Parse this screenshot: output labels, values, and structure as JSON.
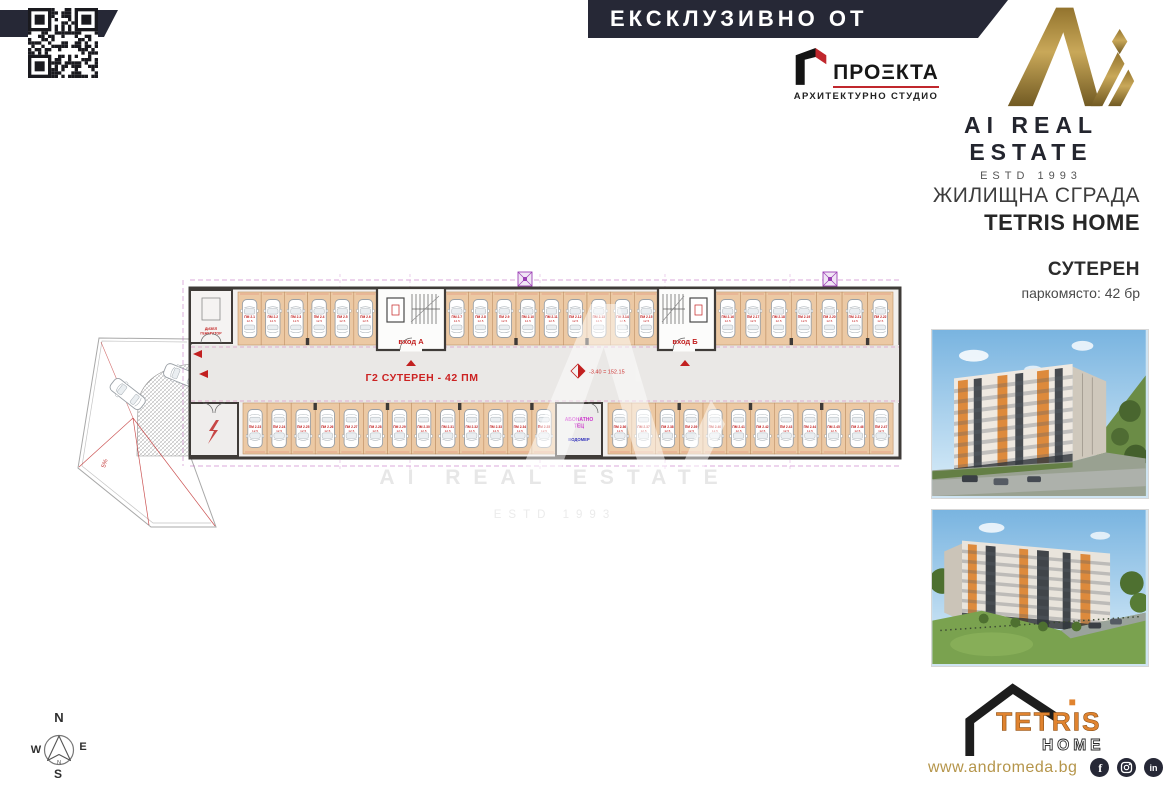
{
  "header": {
    "banner_text": "ЕКСКЛУЗИВНО ОТ",
    "brand_name": "AI REAL ESTATE",
    "brand_estd": "ESTD 1993",
    "architect_name": "ПРОΞКТА",
    "architect_subtitle": "АРХИТЕКТУРНО СТУДИО"
  },
  "sidebar": {
    "building_type": "ЖИЛИЩНА СГРАДА",
    "building_name": "TETRIS HOME",
    "level_title": "СУТЕРЕН",
    "parking_count": "паркомясто: 42 бр",
    "website": "www.andromeda.bg",
    "logo_top": "TETRIS",
    "logo_bottom": "HOME",
    "social_glyphs": {
      "facebook": "f",
      "linkedin": "in"
    }
  },
  "plan": {
    "title": "Г2  СУТЕРЕН - 42 ПМ",
    "elevation": "-3.40 = 152.15",
    "entrance_a": "вход А",
    "entrance_b": "вход Б",
    "room_heat_line1": "АБОНАТНО",
    "room_heat_line2": "ТЕЦ",
    "room_meter": "ВОДОМЕР",
    "generator_line1": "ДИЗЕЛ",
    "generator_line2": "ГЕНЕРАТОР",
    "ramp_slope": "5%",
    "stall_prefix": "ПМ 2.",
    "stall_area": "12.5",
    "watermark_line1": "AI REAL ESTATE",
    "watermark_line2": "ESTD 1993",
    "layout": {
      "top": [
        {
          "x0": 163,
          "x1": 302,
          "count": 6
        },
        {
          "x0": 370,
          "x1": 583,
          "count": 9
        },
        {
          "x0": 640,
          "x1": 818,
          "count": 7
        }
      ],
      "bottom": [
        {
          "x0": 168,
          "x1": 481,
          "count": 13
        },
        {
          "x0": 533,
          "x1": 818,
          "count": 12
        }
      ]
    }
  },
  "compass": {
    "n": "N",
    "e": "E",
    "s": "S",
    "w": "W"
  },
  "colors": {
    "navy": "#262836",
    "gold": "#a8873c",
    "accent_red": "#c0272d",
    "stall_tan": "#ecc9a4",
    "magenta": "#cc44bb",
    "tetris_orange": "#e0832f"
  }
}
